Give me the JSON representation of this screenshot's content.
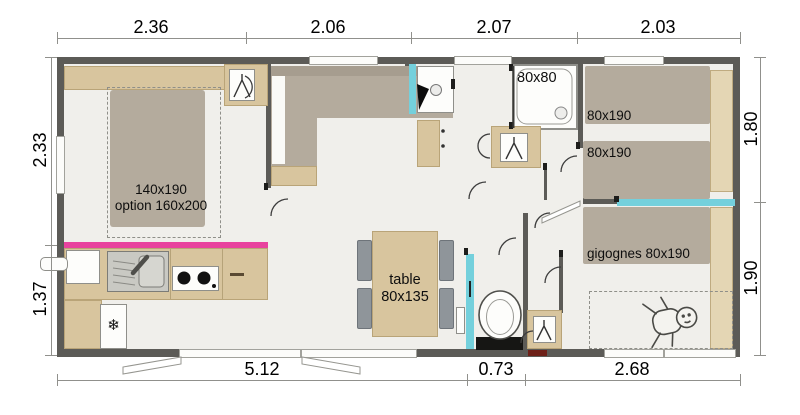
{
  "plan": {
    "type": "floorplan",
    "units": "m",
    "dimensions": {
      "top": [
        "2.36",
        "2.06",
        "2.07",
        "2.03"
      ],
      "left": [
        "2.33",
        "1.37"
      ],
      "right": [
        "1.80",
        "1.90"
      ],
      "bottom": [
        "5.12",
        "0.73",
        "2.68"
      ]
    },
    "labels": {
      "master_bed_size": "140x190",
      "master_bed_option": "option 160x200",
      "shower_size": "80x80",
      "twin_bed_1": "80x190",
      "twin_bed_2": "80x190",
      "trundle_bed": "gigognes 80x190",
      "table_word": "table",
      "table_size": "80x135"
    },
    "icons": {
      "snowflake": "❄",
      "wardrobe": "hanger-icon",
      "baby": "baby-figure"
    },
    "colors": {
      "wall": "#5c5b57",
      "floor": "#f0efeb",
      "wood": "#d8c59e",
      "upholstery": "#b4ab9d",
      "accent_teal": "#74d0dc",
      "accent_magenta": "#e8429e",
      "chair": "#8f959a",
      "threshold_red": "#6e2018"
    }
  }
}
